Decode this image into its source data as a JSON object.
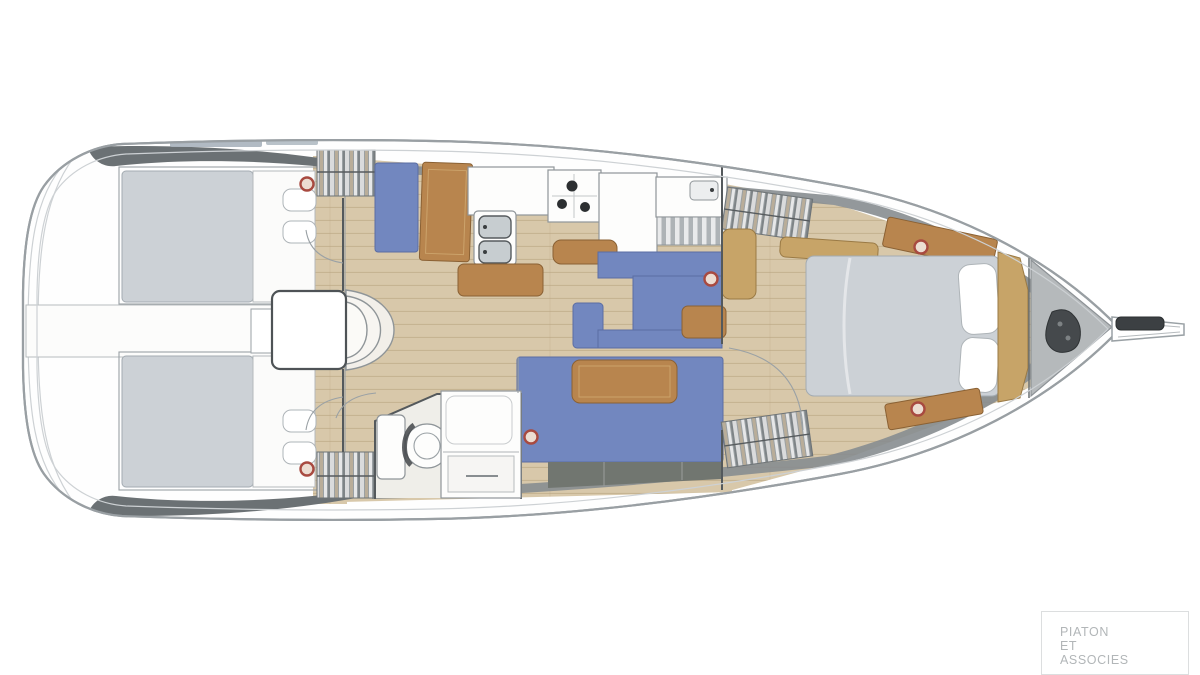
{
  "watermark": {
    "line1": "PIATON",
    "line2": "ET",
    "line3": "ASSOCIES"
  },
  "palette": {
    "background": "#ffffff",
    "wood_floor": "#d8c8aa",
    "wood_dark": "#b8854e",
    "wood_mid": "#c7a468",
    "upholstery_blue": "#7287bf",
    "mattress_gray": "#ccd1d6",
    "deck_shadow": "#6b7174",
    "deck_band": "#878d90",
    "locker_gray": "#717670",
    "porthole_red": "#a84a40",
    "anchor_gray": "#b5b9bb",
    "anchor_dark": "#45494c",
    "hull_stroke": "#999fa3",
    "line_dark": "#54595c",
    "watermark_gray": "#b2b6b8"
  }
}
